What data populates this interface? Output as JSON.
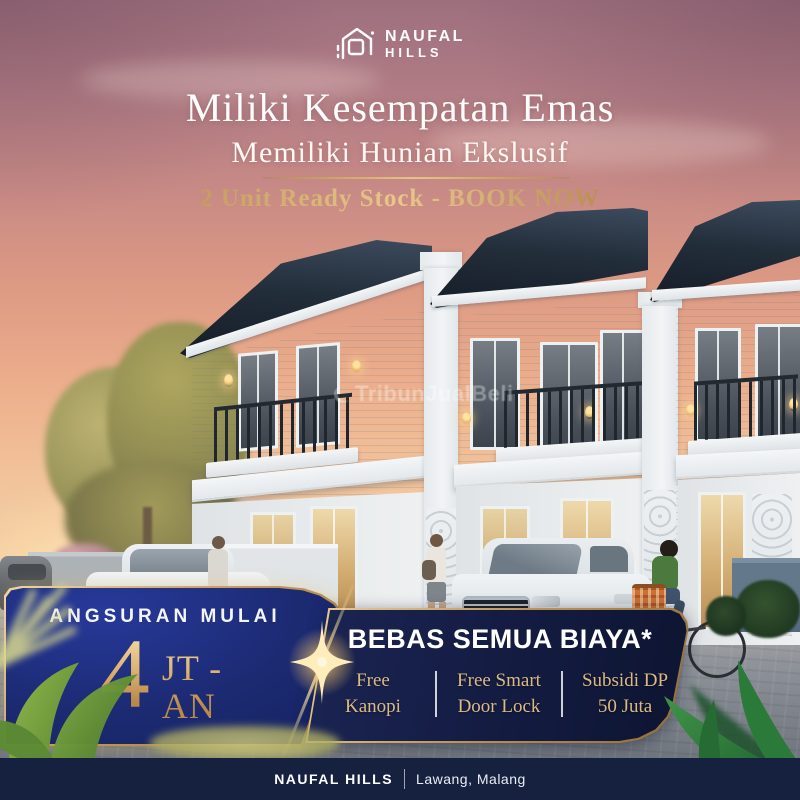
{
  "brand": {
    "name_line1": "NAUFAL",
    "name_line2": "HILLS"
  },
  "hero": {
    "title": "Miliki Kesempatan Emas",
    "subtitle": "Memiliki Hunian Ekslusif",
    "availability": "2 Unit Ready Stock - BOOK NOW"
  },
  "watermark": {
    "text": "TribunJualBeli"
  },
  "installment_card": {
    "label": "ANGSURAN MULAI",
    "amount": "4",
    "unit_top": "JT -",
    "unit_bottom": "AN"
  },
  "promo_card": {
    "title": "BEBAS SEMUA BIAYA*",
    "features": [
      {
        "line1": "Free",
        "line2": "Kanopi"
      },
      {
        "line1": "Free Smart",
        "line2": "Door Lock"
      },
      {
        "line1": "Subsidi DP",
        "line2": "50 Juta"
      }
    ]
  },
  "footer": {
    "brand": "NAUFAL HILLS",
    "location": "Lawang, Malang"
  },
  "colors": {
    "royal_blue": "#1c2a72",
    "navy": "#131b41",
    "gold": "#c9a263",
    "gold_light": "#e9c88c",
    "footer_navy": "#162140"
  }
}
